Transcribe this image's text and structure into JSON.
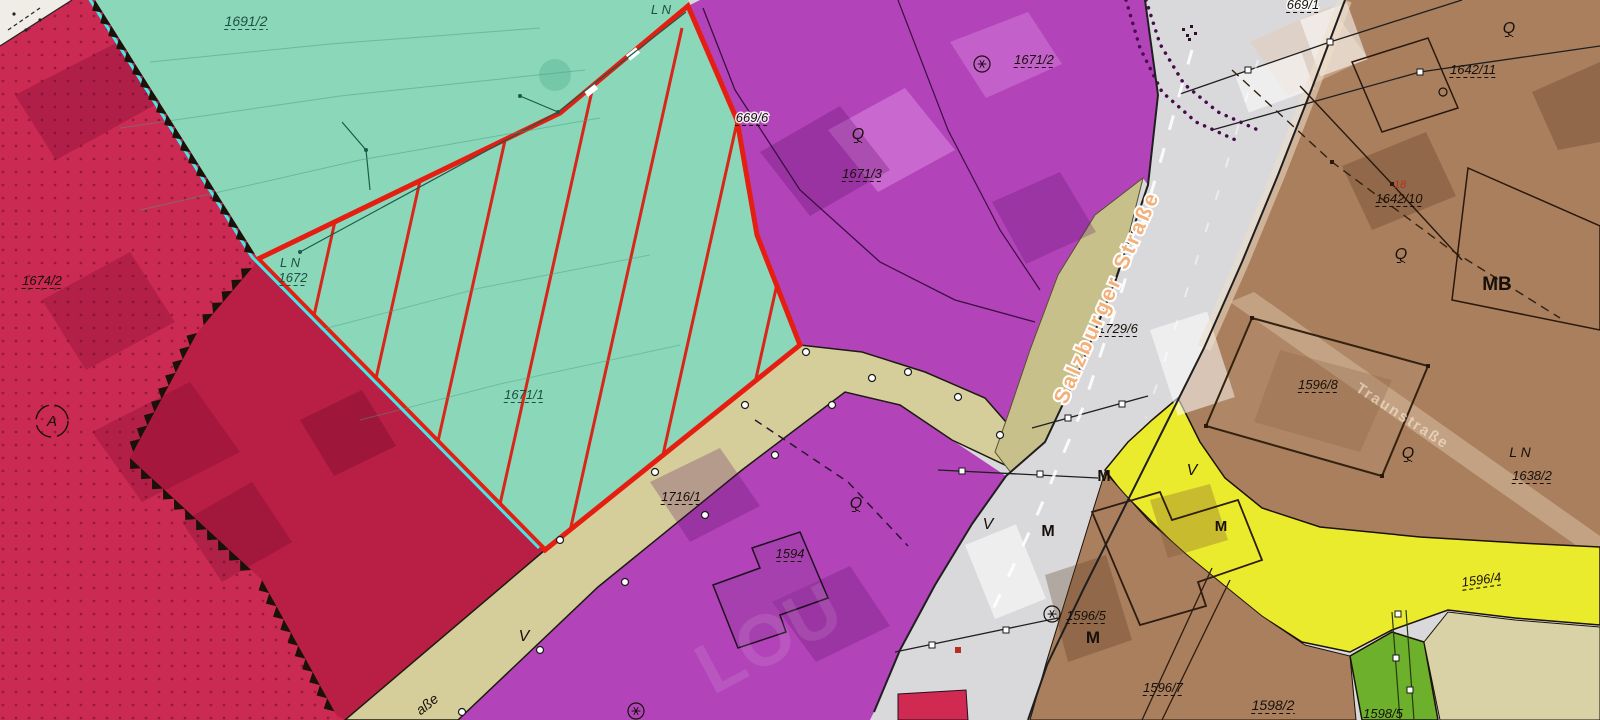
{
  "map": {
    "type": "zoning-cadastral-map",
    "colors": {
      "ink": "#17100a",
      "dkteal": "#1e4f40",
      "redLabel": "#b5311f",
      "crimson": "#cb2a53",
      "crimsonDark": "#b91e45",
      "teal": "#8bd7ba",
      "cyan": "#45e7e7",
      "magenta": "#b243b9",
      "road": "#d9d9dc",
      "tan": "#d5ce9a",
      "khaki": "#c8c08b",
      "brown": "#a97f5e",
      "yellow": "#ebeb2e",
      "green": "#6cb02b",
      "beige": "#d8d2a6",
      "selection": "#e51e12",
      "hatch": "#d8261a",
      "white": "#f0ede7"
    },
    "labels": [
      {
        "t": "1691/2",
        "x": 246,
        "y": 26,
        "fs": 14,
        "c": "dkteal",
        "it": true,
        "u": true
      },
      {
        "t": "L N",
        "x": 661,
        "y": 14,
        "fs": 13,
        "c": "dkteal",
        "it": true
      },
      {
        "t": "L N",
        "x": 290,
        "y": 267,
        "fs": 13,
        "c": "dkteal",
        "it": true
      },
      {
        "t": "1672",
        "x": 293,
        "y": 282,
        "fs": 13,
        "c": "dkteal",
        "it": true,
        "u": true
      },
      {
        "t": "1671/1",
        "x": 524,
        "y": 399,
        "fs": 13,
        "c": "dkteal",
        "it": true,
        "u": true
      },
      {
        "t": "1674/2",
        "x": 42,
        "y": 285,
        "fs": 13,
        "c": "ink",
        "it": true,
        "u": true
      },
      {
        "t": "1716/1",
        "x": 681,
        "y": 501,
        "fs": 13,
        "c": "ink",
        "it": true,
        "u": true
      },
      {
        "t": "V",
        "x": 524,
        "y": 641,
        "fs": 16,
        "c": "ink",
        "it": true
      },
      {
        "t": "1729/6",
        "x": 1118,
        "y": 333,
        "fs": 13,
        "c": "ink",
        "it": true,
        "u": true
      },
      {
        "t": "V",
        "x": 988,
        "y": 529,
        "fs": 16,
        "c": "ink",
        "it": true
      },
      {
        "t": "669/6",
        "x": 752,
        "y": 122,
        "fs": 13,
        "c": "ink",
        "it": true,
        "u": true,
        "halo": true
      },
      {
        "t": "Q",
        "x": 858,
        "y": 139,
        "fs": 16,
        "c": "ink",
        "it": true,
        "u": true
      },
      {
        "t": "1671/3",
        "x": 862,
        "y": 178,
        "fs": 13,
        "c": "ink",
        "it": true,
        "u": true
      },
      {
        "t": "1671/2",
        "x": 1034,
        "y": 64,
        "fs": 13,
        "c": "ink",
        "it": true,
        "u": true
      },
      {
        "t": "1594",
        "x": 790,
        "y": 558,
        "fs": 13,
        "c": "ink",
        "it": true,
        "u": true
      },
      {
        "t": "Q",
        "x": 856,
        "y": 508,
        "fs": 16,
        "c": "ink",
        "it": true,
        "u": true
      },
      {
        "t": "669/1",
        "x": 1303,
        "y": 9,
        "fs": 13,
        "c": "ink",
        "it": true,
        "u": true,
        "halo": true
      },
      {
        "t": "Q",
        "x": 1509,
        "y": 33,
        "fs": 16,
        "c": "ink",
        "it": true,
        "u": true
      },
      {
        "t": "1642/11",
        "x": 1473,
        "y": 74,
        "fs": 13,
        "c": "ink",
        "it": true,
        "u": true
      },
      {
        "t": "18",
        "x": 1400,
        "y": 188,
        "fs": 11,
        "c": "redLabel",
        "it": true
      },
      {
        "t": "1642/10",
        "x": 1399,
        "y": 203,
        "fs": 13,
        "c": "ink",
        "it": true,
        "u": true
      },
      {
        "t": "MB",
        "x": 1497,
        "y": 290,
        "fs": 19,
        "c": "ink",
        "b": true
      },
      {
        "t": "Q",
        "x": 1401,
        "y": 259,
        "fs": 16,
        "c": "ink",
        "it": true,
        "u": true
      },
      {
        "t": "1596/8",
        "x": 1318,
        "y": 389,
        "fs": 13,
        "c": "ink",
        "it": true,
        "u": true
      },
      {
        "t": "Q",
        "x": 1408,
        "y": 458,
        "fs": 16,
        "c": "ink",
        "it": true,
        "u": true
      },
      {
        "t": "L N",
        "x": 1520,
        "y": 457,
        "fs": 14,
        "c": "ink",
        "it": true
      },
      {
        "t": "1638/2",
        "x": 1532,
        "y": 480,
        "fs": 13,
        "c": "ink",
        "it": true,
        "u": true
      },
      {
        "t": "V",
        "x": 1192,
        "y": 475,
        "fs": 16,
        "c": "ink",
        "it": true
      },
      {
        "t": "1596/4",
        "x": 1482,
        "y": 584,
        "fs": 13,
        "c": "ink",
        "it": true,
        "u": true,
        "rot": -8
      },
      {
        "t": "M",
        "x": 1048,
        "y": 536,
        "fs": 16,
        "c": "ink",
        "b": true
      },
      {
        "t": "M",
        "x": 1104,
        "y": 481,
        "fs": 16,
        "c": "ink",
        "b": true
      },
      {
        "t": "M",
        "x": 1221,
        "y": 531,
        "fs": 15,
        "c": "ink",
        "b": true
      },
      {
        "t": "1596/5",
        "x": 1086,
        "y": 620,
        "fs": 13,
        "c": "ink",
        "it": true,
        "u": true
      },
      {
        "t": "M",
        "x": 1093,
        "y": 643,
        "fs": 17,
        "c": "ink",
        "b": true
      },
      {
        "t": "1596/7",
        "x": 1163,
        "y": 692,
        "fs": 13,
        "c": "ink",
        "it": true,
        "u": true
      },
      {
        "t": "1598/2",
        "x": 1273,
        "y": 710,
        "fs": 14,
        "c": "ink",
        "it": true,
        "u": true
      },
      {
        "t": "1598/5",
        "x": 1383,
        "y": 718,
        "fs": 13,
        "c": "ink",
        "it": true
      },
      {
        "t": "Salzburger Straße",
        "x": 1113,
        "y": 300,
        "fs": 21,
        "rot": -66,
        "role": "street-major"
      },
      {
        "t": "Traunstraße",
        "x": 1400,
        "y": 420,
        "fs": 15,
        "rot": 33,
        "role": "street-faint"
      },
      {
        "t": "aße",
        "x": 430,
        "y": 708,
        "fs": 14,
        "rot": -39,
        "c": "ink",
        "it": true,
        "role": "street-small"
      }
    ],
    "symbols": [
      {
        "k": "circle-star",
        "x": 982,
        "y": 64,
        "r": 8
      },
      {
        "k": "circle-star",
        "x": 1052,
        "y": 614,
        "r": 8
      },
      {
        "k": "circle-star",
        "x": 636,
        "y": 711,
        "r": 8
      },
      {
        "k": "circle-letter",
        "t": "A",
        "x": 52,
        "y": 421,
        "r": 16
      },
      {
        "k": "small-circle",
        "x": 1443,
        "y": 92,
        "r": 4
      },
      {
        "k": "small-red-dot",
        "x": 958,
        "y": 650,
        "r": 3
      },
      {
        "k": "glyph-cluster",
        "x": 1188,
        "y": 32
      }
    ],
    "watermark": {
      "t": "LOU",
      "x": 780,
      "y": 660,
      "rot": -28,
      "fs": 72
    }
  }
}
